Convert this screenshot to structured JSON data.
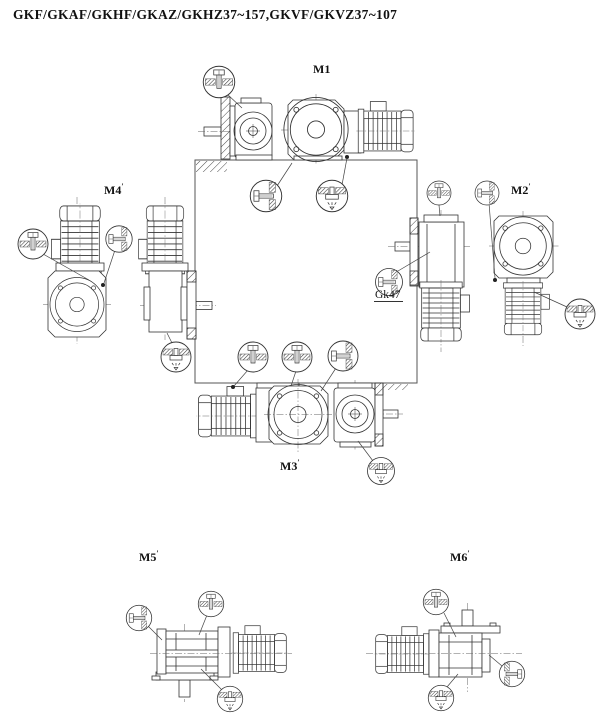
{
  "title": "GKF/GKAF/GKHF/GKAZ/GKHZ37~157,GKVF/GKVZ37~107",
  "diagram": {
    "description": "Mounting position diagram for helical-bevel gear motors, positions M1-M6 around reference cube",
    "positions": [
      {
        "id": "m1",
        "label": "M1",
        "mark": ""
      },
      {
        "id": "m2",
        "label": "M2",
        "mark": "′"
      },
      {
        "id": "m3",
        "label": "M3",
        "mark": "′"
      },
      {
        "id": "m4",
        "label": "M4",
        "mark": "′"
      },
      {
        "id": "m5",
        "label": "M5",
        "mark": "′"
      },
      {
        "id": "m6",
        "label": "M6",
        "mark": "′"
      }
    ],
    "callout_label": "Gk47",
    "symbols": {
      "breather": "breather-plug",
      "level": "oil-level-plug",
      "drain": "oil-drain-plug"
    },
    "colors": {
      "line": "#333333",
      "hatch": "#4a4a4a",
      "background": "#ffffff"
    }
  }
}
